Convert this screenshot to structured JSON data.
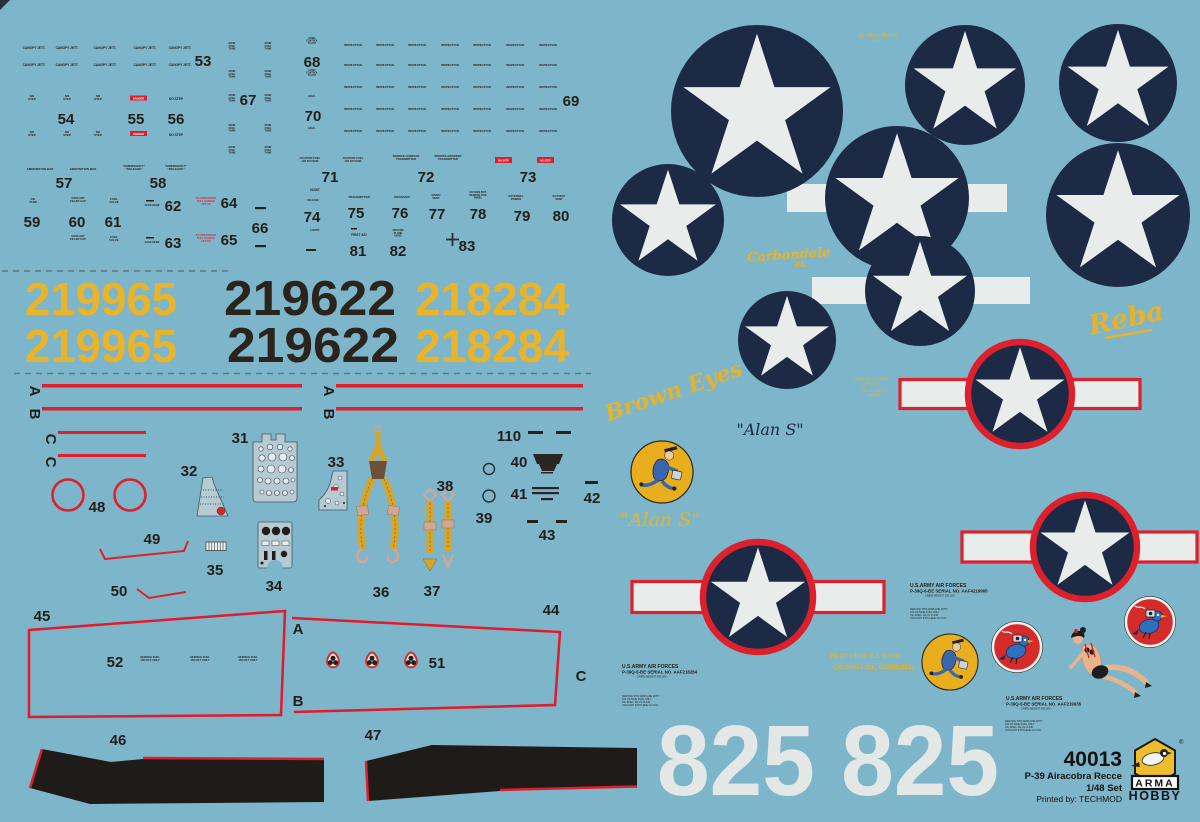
{
  "sheet": {
    "bg": "#7db5ca",
    "navy": "#1d2a45",
    "red": "#dd202b",
    "yellow": "#e7b32b",
    "white": "#e8edec",
    "ink": "#28221c"
  },
  "product": {
    "code": "40013",
    "name": "P-39 Airacobra Recce",
    "scale": "1/48 Set",
    "printed_by": "Printed by: TECHMOD",
    "brand_top": "ARMA",
    "brand_bottom": "HOBBY",
    "reg": "®"
  },
  "serials": {
    "s1": "219965",
    "s2": "219622",
    "s3": "218284"
  },
  "tail_number": "825 825",
  "scripts": {
    "pilot_top": "Lt. Pete Boffill",
    "pilot_top_sub": "PILOT",
    "carbondale": "Carbondale",
    "carbondale_sub": "PA.",
    "reba": "Reba",
    "brown_eyes": "Brown Eyes",
    "alan_s": "\"Alan S\"",
    "crew1": "S/Sgt. Jack Aponik",
    "crew1_sub": "CREW CHIEF",
    "crew2": "Sgt. L. Baum",
    "crew2_sub": "ARMORER",
    "pilot_line": "PILOT   LIEUT. C.J. DAVIS",
    "cc_line": "C/C   S/SGT. C.L. CEDRICELLI"
  },
  "blocks": {
    "b1": [
      "U.S.ARMY AIR FORCES",
      "P-39Q-6-BE SERIAL NO. AAF4219965",
      "CREW WEIGHT 200 LBS."
    ],
    "b2": [
      "U.S.ARMY AIR FORCES",
      "P-39Q-5-BE SERIAL NO. AAF218284",
      "CREW WEIGHT 200 LBS."
    ],
    "b3": [
      "U.S.ARMY AIR FORCES",
      "P-39Q-5-BE SERIAL NO. AAF219935",
      "CREW WEIGHT 200 LBS."
    ],
    "warning": "SERVICE THIS AIRPLANE WITH\n100 OCTANE FUEL ONLY\nOIL SPEC. AN-VV-O-446\nCOOLANT ETHYLENE GLYCOL"
  },
  "stencils": {
    "canopy": "CANOPY JETT.",
    "no_step2": "NO\nSTEP",
    "danger": "DANGER",
    "no_step": "NO STEP",
    "mft": "MAIN\nFUEL\nTANK",
    "cowl": "COWL\nCONTROL\nPLATE",
    "max": "MAX.",
    "inspection": "INSPECTION",
    "ammo": "AMMUNITION BOX",
    "emergency": "\"EMERGENCY\"\n\"RELEASE\"",
    "oil": "OIL\nTANK",
    "coolant": "COOLANT\nFILLER CAP",
    "fuel_valve": "FUEL\nVALVE",
    "jack": "JACK HERE",
    "open_door": "TO OPEN DOOR\nPULL HANDLE\nLIFT UP",
    "av_fuel": "AVIATION FUEL\n100 OCTANE",
    "rcompass": "REMOTE COMPASS\nTRANSMITTER",
    "rairspeed": "REMOTE AIRSPEED\nTRANSMITTER",
    "hoist": "HOIST",
    "release": "RELEASE",
    "transmitter": "TRANSMITTER",
    "receiver": "RECEIVER",
    "radio_vent": "RADIO\nVENT",
    "oxygen": "OXYGEN BOT.\nREMOVE THIS\nPANEL",
    "ext_power": "EXTERNAL\nPOWER",
    "battery": "BATTERY\nVENT",
    "first_aid": "FIRST AID",
    "ground": "GROUND\nPLANE\nHERE",
    "fuel_service": "SERVICE FUEL\n100 OCT. ONLY"
  },
  "part_labels": {
    "n31": "31",
    "n32": "32",
    "n33": "33",
    "n34": "34",
    "n35": "35",
    "n36": "36",
    "n37": "37",
    "n38": "38",
    "n39": "39",
    "n40": "40",
    "n41": "41",
    "n42": "42",
    "n43": "43",
    "n44": "44",
    "n45": "45",
    "n46": "46",
    "n47": "47",
    "n48": "48",
    "n49": "49",
    "n50": "50",
    "n51": "51",
    "n52": "52",
    "n53": "53",
    "n54": "54",
    "n55": "55",
    "n56": "56",
    "n57": "57",
    "n58": "58",
    "n59": "59",
    "n60": "60",
    "n61": "61",
    "n62": "62",
    "n63": "63",
    "n64": "64",
    "n65": "65",
    "n66": "66",
    "n67": "67",
    "n68": "68",
    "n69": "69",
    "n70": "70",
    "n71": "71",
    "n72": "72",
    "n73": "73",
    "n74": "74",
    "n75": "75",
    "n76": "76",
    "n77": "77",
    "n78": "78",
    "n79": "79",
    "n80": "80",
    "n81": "81",
    "n82": "82",
    "n83": "83",
    "n110": "110",
    "A": "A",
    "B": "B",
    "C": "C"
  }
}
